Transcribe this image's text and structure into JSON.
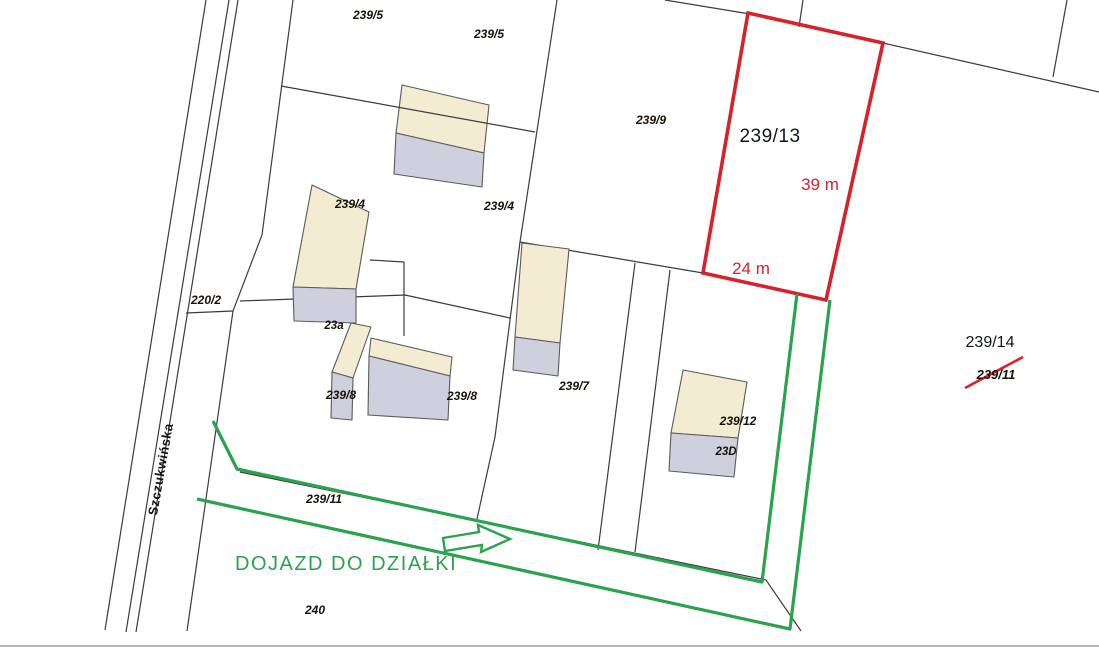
{
  "map": {
    "title": "cadastral-parcel-map",
    "street": "Szczukwińska",
    "access_route_label": "DOJAZD DO DZIAŁKI",
    "highlighted_parcel": {
      "number": "239/13",
      "side_length": "39 m",
      "front_length": "24 m"
    },
    "labels": {
      "p239_5_a": "239/5",
      "p239_5_b": "239/5",
      "p239_9": "239/9",
      "p239_4_a": "239/4",
      "p239_4_b": "239/4",
      "p220_2": "220/2",
      "b23a": "23a",
      "p239_8_a": "239/8",
      "p239_8_b": "239/8",
      "p239_7": "239/7",
      "p239_12": "239/12",
      "b23D": "23D",
      "p239_11_road": "239/11",
      "p240": "240",
      "p239_13": "239/13",
      "dim_side": "39 m",
      "dim_front": "24 m",
      "p239_14": "239/14",
      "p239_11_struck": "239/11",
      "access": "DOJAZD DO DZIAŁKI",
      "street": "Szczukwińska"
    },
    "colors": {
      "highlight_red": "#d6222a",
      "route_green": "#2ba24e",
      "building_roof": "#f4ecd2",
      "building_front": "#cfd0de",
      "boundary_line": "#3c3c3c",
      "bottom_rule": "#b7b7b7"
    }
  }
}
